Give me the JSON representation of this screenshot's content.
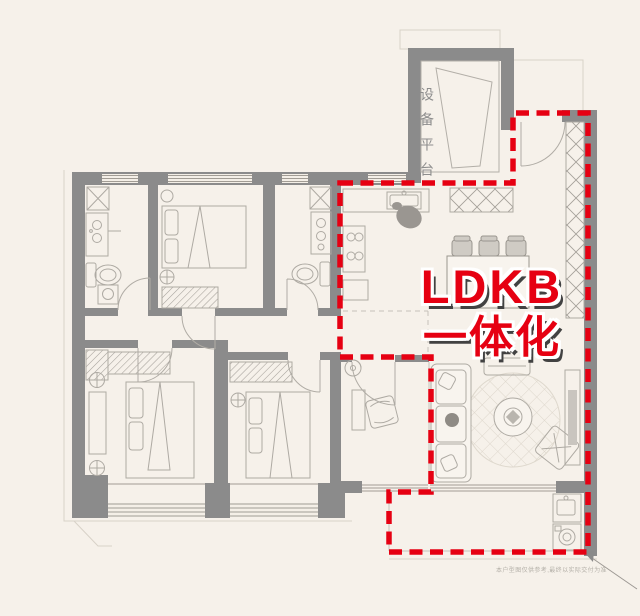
{
  "palette": {
    "background": "#f6f1ea",
    "wall_gray": "#8b8b8b",
    "furniture_line_gray": "#aeaaa3",
    "window_line_gray": "#a19c94",
    "accent_red": "#e60012",
    "highlight_shadow": "#424242",
    "label_gray": "#8d8d8d"
  },
  "floorplan": {
    "platform_label": "设备平台",
    "highlight_line1": "LDKB",
    "highlight_line2": "一体化",
    "disclaimer": "本户型图仅供参考,最终以实际交付为准"
  },
  "icons": {
    "bed-icon": "svg-outline",
    "wardrobe-hatch-icon": "diagonal-hatch",
    "toilet-icon": "svg-outline",
    "vanity-sink-icon": "svg-outline",
    "shower-icon": "x-box",
    "stove-icon": "4-burner-grid",
    "kitchen-sink-icon": "svg-outline",
    "dining-table-icon": "svg-outline",
    "dining-chair-icon": "svg-outline",
    "sofa-icon": "svg-outline",
    "rug-icon": "diamond-circle",
    "coffee-table-icon": "circle",
    "lounge-chair-icon": "rotated-square",
    "tv-console-icon": "svg-outline",
    "washing-machine-icon": "circle-door-box",
    "laundry-sink-icon": "svg-outline",
    "entry-door-arc-icon": "quarter-arc",
    "storage-cabinet-icon": "x-hatch-strip",
    "plant-icon": "gray-blob",
    "ac-unit-icon": "fan-circle"
  }
}
